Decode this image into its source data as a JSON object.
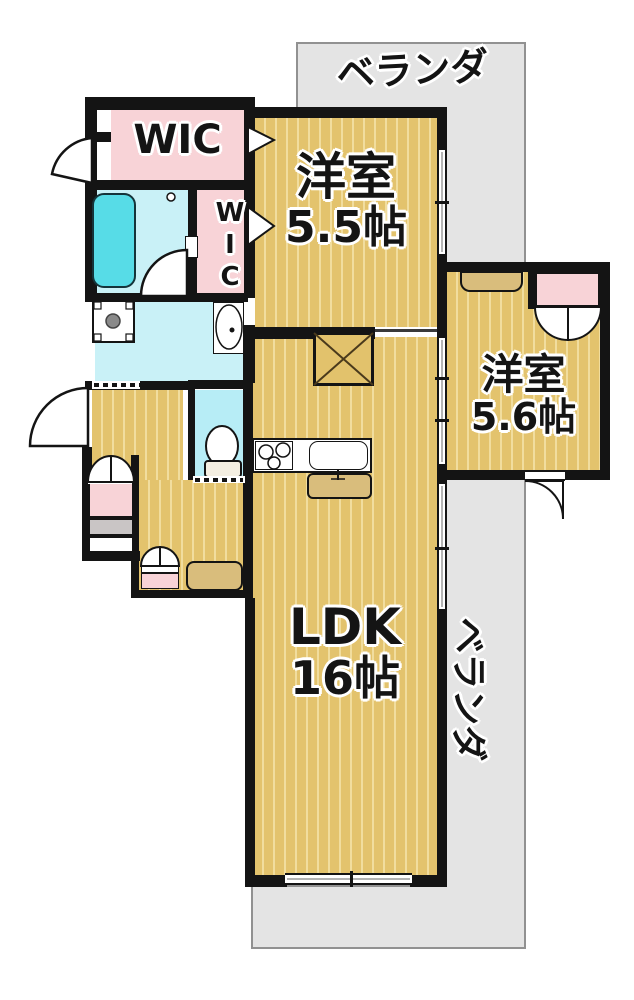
{
  "plan": {
    "labels": {
      "veranda_top": "ベランダ",
      "veranda_side": "ベランダ",
      "wic_main": "WIC",
      "wic_side": "WIC",
      "bedroom_a_name": "洋室",
      "bedroom_a_size": "5.5帖",
      "bedroom_b_name": "洋室",
      "bedroom_b_size": "5.6帖",
      "ldk_name": "LDK",
      "ldk_size": "16帖"
    },
    "colors": {
      "floor_base": "#e3c36d",
      "floor_stripe": "#f1dd9e",
      "wall": "#141414",
      "wet_area_floor": "#c9f1f7",
      "toilet_floor": "#b7edf6",
      "bathtub": "#57dce7",
      "closet_pink": "#f8d3d7",
      "veranda_gray": "#e4e4e4",
      "furniture_tan": "#d9bd7c"
    }
  }
}
